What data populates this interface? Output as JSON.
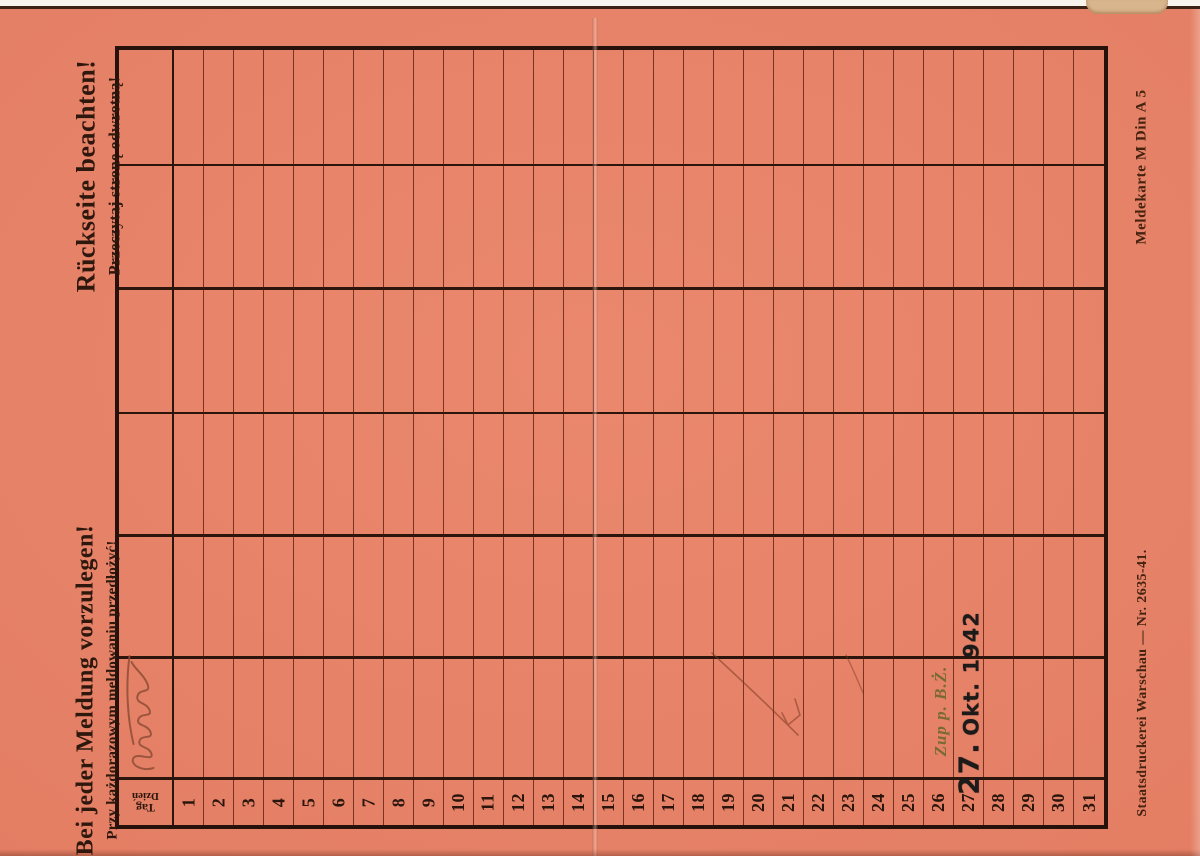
{
  "colors": {
    "card": "#e87f63",
    "grid_heavy": "#2b150c",
    "grid_light": "#5a190c",
    "stamp_ink": "#1d1b19",
    "note_ink": "#6e682f",
    "signature_ink": "#8f4e36"
  },
  "left_margin": {
    "meldung": {
      "de": "Bei jeder Meldung vorzulegen!",
      "pl": "Przy każdorazowym meldowaniu przedłożyć!"
    },
    "rueckseite": {
      "de": "Rückseite beachten!",
      "pl": "Przeczytaj stronę odwrotną!"
    }
  },
  "right_margin": {
    "form_label": "Meldekarte M Din A 5",
    "printer_label": "Staatsdruckerei Warschau — Nr. 2635-41."
  },
  "table": {
    "day_header": {
      "de": "Tag",
      "pl": "Dzień"
    },
    "days": [
      "1",
      "2",
      "3",
      "4",
      "5",
      "6",
      "7",
      "8",
      "9",
      "10",
      "11",
      "12",
      "13",
      "14",
      "15",
      "16",
      "17",
      "18",
      "19",
      "20",
      "21",
      "22",
      "23",
      "24",
      "25",
      "26",
      "27",
      "28",
      "29",
      "30",
      "31"
    ]
  },
  "stamp": {
    "day": "27.",
    "month_year": "Okt. 1942"
  },
  "handwriting": {
    "note": "Zup p. B.Ż.",
    "signature": "illegible"
  }
}
